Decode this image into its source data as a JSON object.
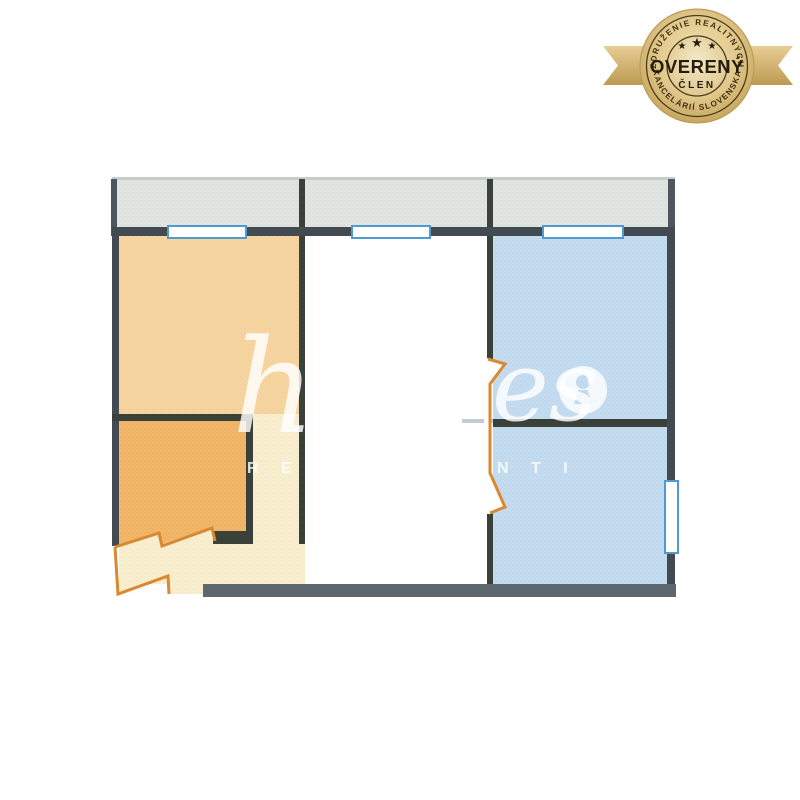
{
  "page": {
    "background": "#ffffff"
  },
  "badge": {
    "arc_top": "ZDRUŽENIE REALITNÝCH",
    "title": "OVERENÝ",
    "subtitle": "ČLEN",
    "arc_bottom": "KANCELÁRIÍ SLOVENSKA",
    "star_char": "★",
    "colors": {
      "gold_center": "#f0e2b2",
      "gold_mid": "#e2ca8e",
      "gold_edge": "#c2a057",
      "inner_center": "#f4e9c6",
      "inner_edge": "#ddc288",
      "ribbon_light": "#e7cd93",
      "ribbon_dark": "#bd9a53",
      "ring": "#4e3d18",
      "text": "#261e0c",
      "arc_text": "#3f3012"
    }
  },
  "watermark": {
    "script_left": "h",
    "script_mid": "es",
    "tagline_left": "R E A",
    "tagline_right": "N T I",
    "color": "rgba(255,255,255,0.82)"
  },
  "floorplan": {
    "colors": {
      "balcony": "#e0e5e1",
      "room_left": "#f7d5a0",
      "room_small": "#f2b669",
      "hallway": "#f9efce",
      "room_middle": "#ffffff",
      "room_blue": "#c4dcf0",
      "wall": "#424b52",
      "wall_dark": "#3a4139",
      "wall_bottom": "#5d6770",
      "balcony_edge": "#4d565e",
      "balcony_top_line": "#c6cec8",
      "threshold": "#c5ccd1",
      "door": "#d98932",
      "window_frame": "#4d9bd2",
      "window_fill": "#ffffff"
    }
  }
}
